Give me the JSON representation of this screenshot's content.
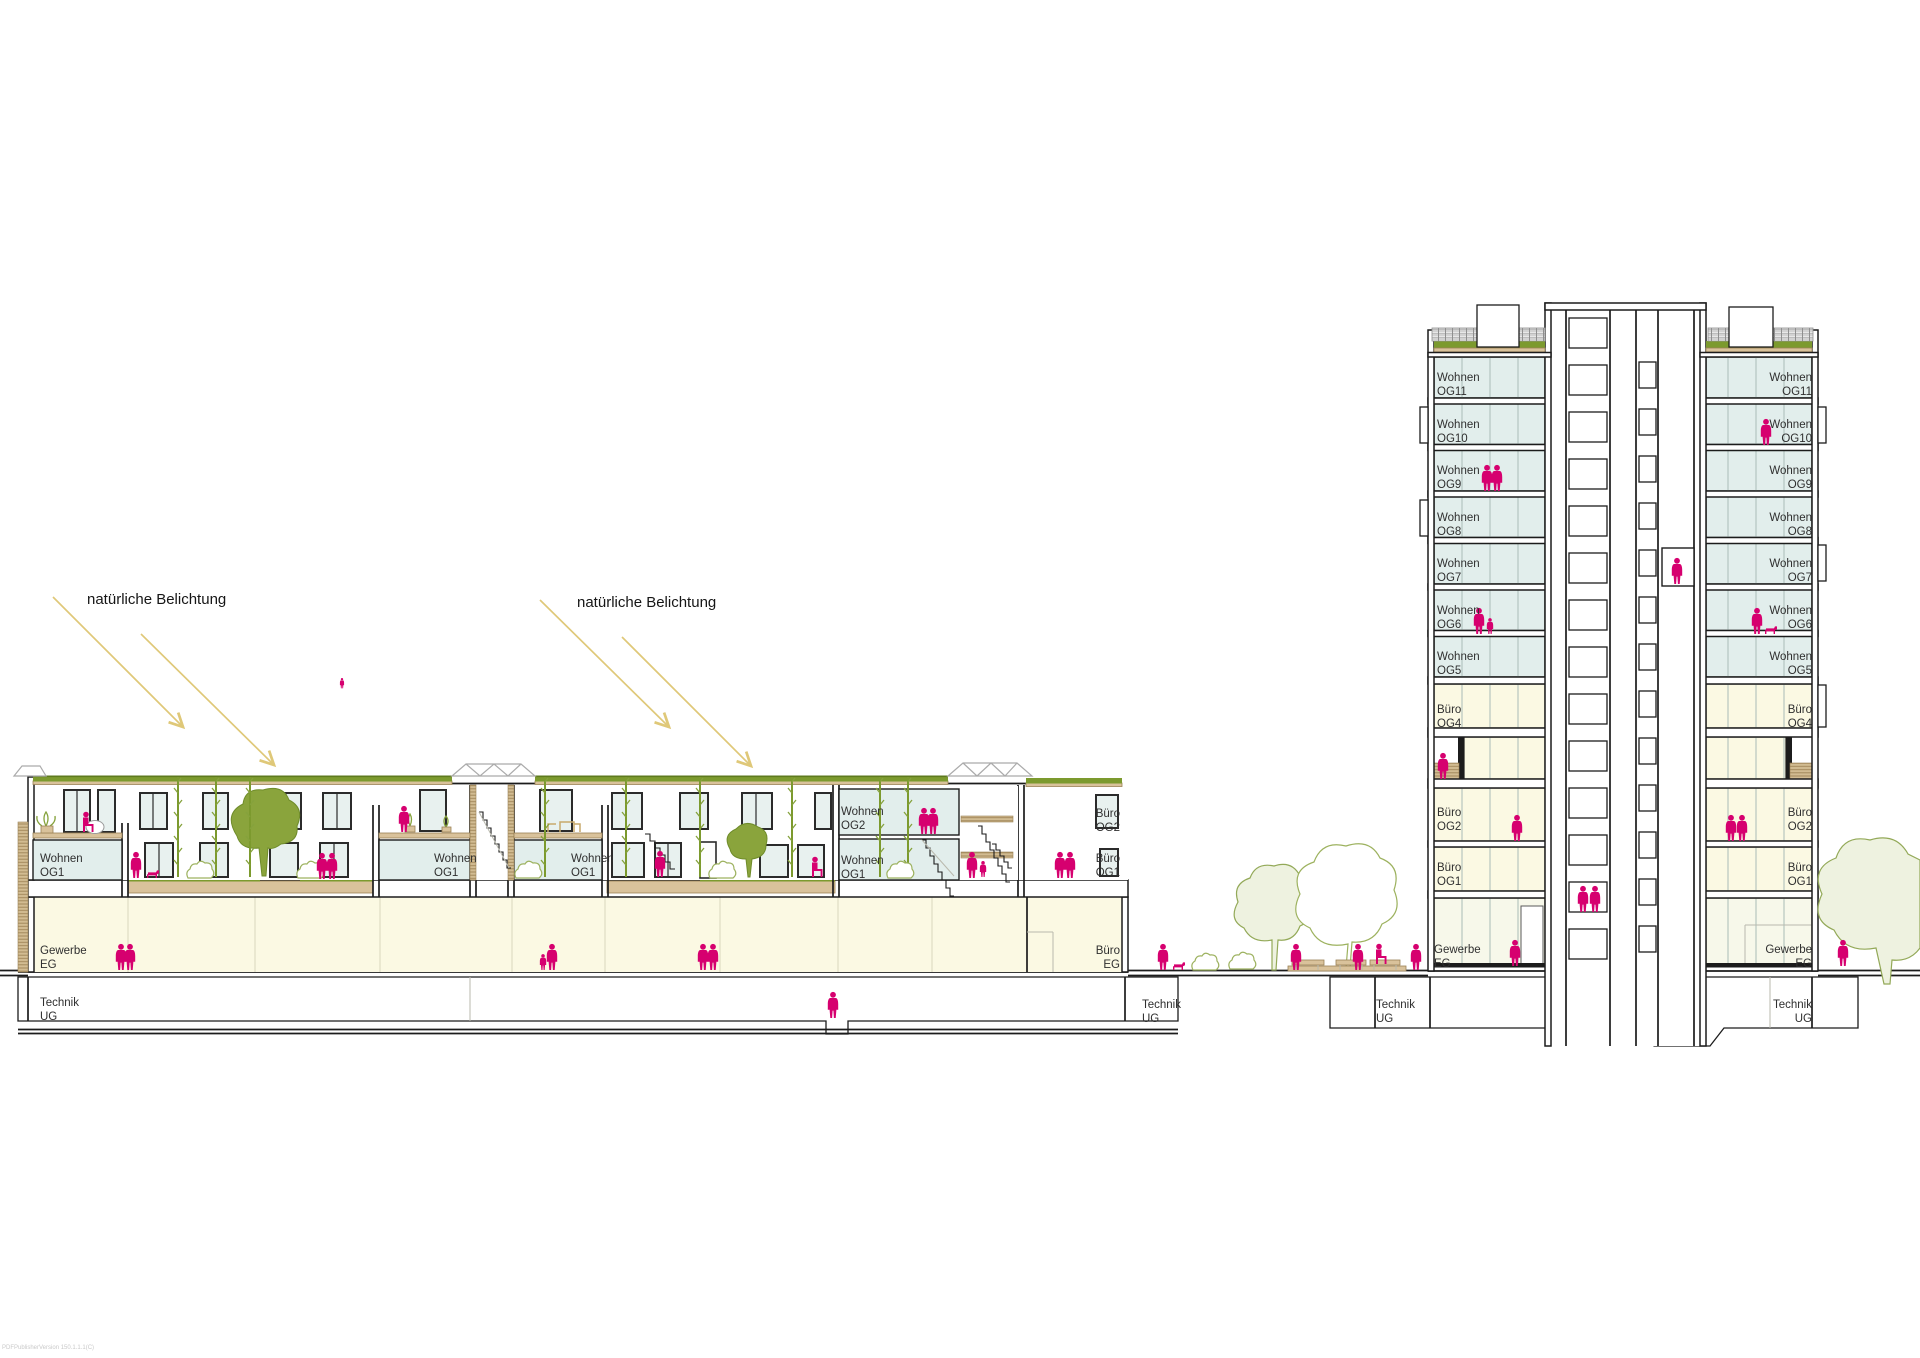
{
  "watermark": "PDFPublisherVersion 150.1.1.1(C)",
  "annotation": {
    "text": "natürliche Belichtung"
  },
  "colors": {
    "people_accent": "#d6006f",
    "vegetation": "#85a23c",
    "daylight_arrow": "#dfc878",
    "glazing": "#e2eeec",
    "interior_yellow": "#fbf9e3",
    "deck_tan": "#d9c29b",
    "roof_grass": "#7c9a2e"
  },
  "labels": [
    {
      "id": "lb-wohnen-og1-1",
      "line1": "Wohnen",
      "line2": "OG1",
      "x": 40,
      "y": 852,
      "align": "left"
    },
    {
      "id": "lb-wohnen-og1-2",
      "line1": "Wohnen",
      "line2": "OG1",
      "x": 434,
      "y": 852,
      "align": "left"
    },
    {
      "id": "lb-wohnen-og1-3",
      "line1": "Wohnen",
      "line2": "OG1",
      "x": 571,
      "y": 852,
      "align": "left"
    },
    {
      "id": "lb-wohnen-og2",
      "line1": "Wohnen",
      "line2": "OG2",
      "x": 841,
      "y": 805,
      "align": "left"
    },
    {
      "id": "lb-wohnen-og1-4",
      "line1": "Wohnen",
      "line2": "OG1",
      "x": 841,
      "y": 854,
      "align": "left"
    },
    {
      "id": "lb-buero-og2",
      "line1": "Büro",
      "line2": "OG2",
      "x": 1120,
      "y": 807,
      "align": "right"
    },
    {
      "id": "lb-buero-og1",
      "line1": "Büro",
      "line2": "OG1",
      "x": 1120,
      "y": 852,
      "align": "right"
    },
    {
      "id": "lb-gewerbe-eg",
      "line1": "Gewerbe",
      "line2": "EG",
      "x": 40,
      "y": 944,
      "align": "left"
    },
    {
      "id": "lb-buero-eg",
      "line1": "Büro",
      "line2": "EG",
      "x": 1120,
      "y": 944,
      "align": "right"
    },
    {
      "id": "lb-technik-ug-1",
      "line1": "Technik",
      "line2": "UG",
      "x": 40,
      "y": 996,
      "align": "left"
    },
    {
      "id": "lb-technik-ug-2",
      "line1": "Technik",
      "line2": "UG",
      "x": 1142,
      "y": 998,
      "align": "left"
    },
    {
      "id": "plaza-technik-ug",
      "line1": "Technik",
      "line2": "UG",
      "x": 1376,
      "y": 998,
      "align": "left"
    },
    {
      "id": "tw-l-og11",
      "line1": "Wohnen",
      "line2": "OG11",
      "x": 1437,
      "y": 371,
      "align": "left"
    },
    {
      "id": "tw-l-og10",
      "line1": "Wohnen",
      "line2": "OG10",
      "x": 1437,
      "y": 418,
      "align": "left"
    },
    {
      "id": "tw-l-og9",
      "line1": "Wohnen",
      "line2": "OG9",
      "x": 1437,
      "y": 464,
      "align": "left"
    },
    {
      "id": "tw-l-og8",
      "line1": "Wohnen",
      "line2": "OG8",
      "x": 1437,
      "y": 511,
      "align": "left"
    },
    {
      "id": "tw-l-og7",
      "line1": "Wohnen",
      "line2": "OG7",
      "x": 1437,
      "y": 557,
      "align": "left"
    },
    {
      "id": "tw-l-og6",
      "line1": "Wohnen",
      "line2": "OG6",
      "x": 1437,
      "y": 604,
      "align": "left"
    },
    {
      "id": "tw-l-og5",
      "line1": "Wohnen",
      "line2": "OG5",
      "x": 1437,
      "y": 650,
      "align": "left"
    },
    {
      "id": "tw-l-og4",
      "line1": "Büro",
      "line2": "OG4",
      "x": 1437,
      "y": 703,
      "align": "left"
    },
    {
      "id": "tw-l-og2",
      "line1": "Büro",
      "line2": "OG2",
      "x": 1437,
      "y": 806,
      "align": "left"
    },
    {
      "id": "tw-l-og1",
      "line1": "Büro",
      "line2": "OG1",
      "x": 1437,
      "y": 861,
      "align": "left"
    },
    {
      "id": "tw-l-eg",
      "line1": "Gewerbe",
      "line2": "EG",
      "x": 1434,
      "y": 943,
      "align": "left"
    },
    {
      "id": "tw-r-og11",
      "line1": "Wohnen",
      "line2": "OG11",
      "x": 1812,
      "y": 371,
      "align": "right"
    },
    {
      "id": "tw-r-og10",
      "line1": "Wohnen",
      "line2": "OG10",
      "x": 1812,
      "y": 418,
      "align": "right"
    },
    {
      "id": "tw-r-og9",
      "line1": "Wohnen",
      "line2": "OG9",
      "x": 1812,
      "y": 464,
      "align": "right"
    },
    {
      "id": "tw-r-og8",
      "line1": "Wohnen",
      "line2": "OG8",
      "x": 1812,
      "y": 511,
      "align": "right"
    },
    {
      "id": "tw-r-og7",
      "line1": "Wohnen",
      "line2": "OG7",
      "x": 1812,
      "y": 557,
      "align": "right"
    },
    {
      "id": "tw-r-og6",
      "line1": "Wohnen",
      "line2": "OG6",
      "x": 1812,
      "y": 604,
      "align": "right"
    },
    {
      "id": "tw-r-og5",
      "line1": "Wohnen",
      "line2": "OG5",
      "x": 1812,
      "y": 650,
      "align": "right"
    },
    {
      "id": "tw-r-og4",
      "line1": "Büro",
      "line2": "OG4",
      "x": 1812,
      "y": 703,
      "align": "right"
    },
    {
      "id": "tw-r-og2",
      "line1": "Büro",
      "line2": "OG2",
      "x": 1812,
      "y": 806,
      "align": "right"
    },
    {
      "id": "tw-r-og1",
      "line1": "Büro",
      "line2": "OG1",
      "x": 1812,
      "y": 861,
      "align": "right"
    },
    {
      "id": "tw-r-eg",
      "line1": "Gewerbe",
      "line2": "EG",
      "x": 1812,
      "y": 943,
      "align": "right"
    },
    {
      "id": "tw-r-technik-ug",
      "line1": "Technik",
      "line2": "UG",
      "x": 1812,
      "y": 998,
      "align": "right"
    }
  ]
}
